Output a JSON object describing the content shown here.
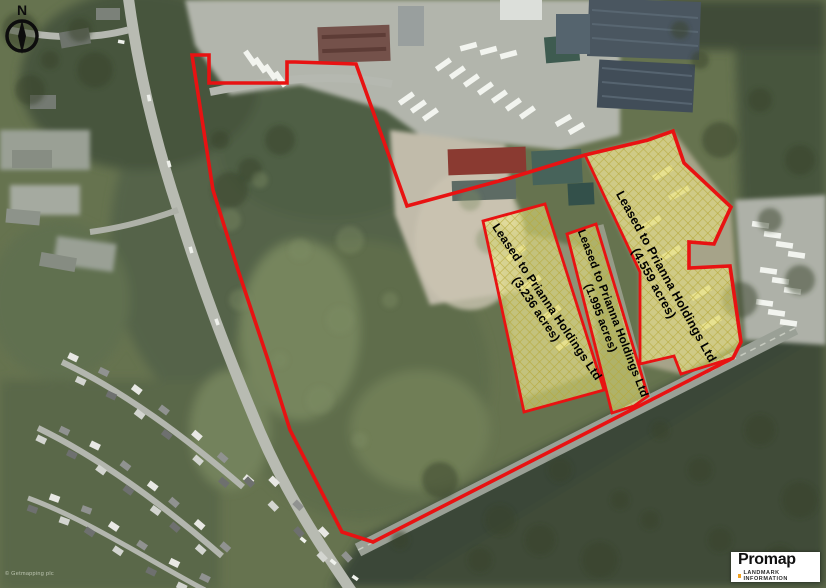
{
  "compass_label": "N",
  "site_boundary_points": "192,55 209,55 209,83 287,83 287,62 295,62 356,64 407,206 510,178 585,155 648,140 673,131 684,163 731,207 714,244 689,242 689,268 730,266 741,342 733,358 373,542 342,532 290,430 268,360 238,270 213,190",
  "parcels": [
    {
      "name": "west",
      "label": "Leased to Prianna Holdings Ltd",
      "acreage": "(3.236 acres)",
      "points": "483,221 545,204 604,390 524,412"
    },
    {
      "name": "middle",
      "label": "Leased to Prianna Holdings Ltd",
      "acreage": "(1.995 acres)",
      "points": "567,234 596,224 648,396 634,406 612,413"
    },
    {
      "name": "east",
      "label": "Leased to Prianna Holdings Ltd",
      "acreage": "(4.559 acres)",
      "points": "585,155 648,140 673,131 684,163 731,207 714,244 689,242 689,268 730,266 741,342 733,358 681,374 674,356 640,364 640,272"
    }
  ],
  "logo": {
    "brand": "Promap",
    "tagline": "LANDMARK INFORMATION"
  },
  "attribution": "© Getmapping plc",
  "colors": {
    "boundary": "#e81212",
    "parcel_fill": "#f8f283",
    "parcel_hatch": "#b7a93c",
    "label_text": "#000000",
    "logo_dot": "#f0a01e"
  }
}
